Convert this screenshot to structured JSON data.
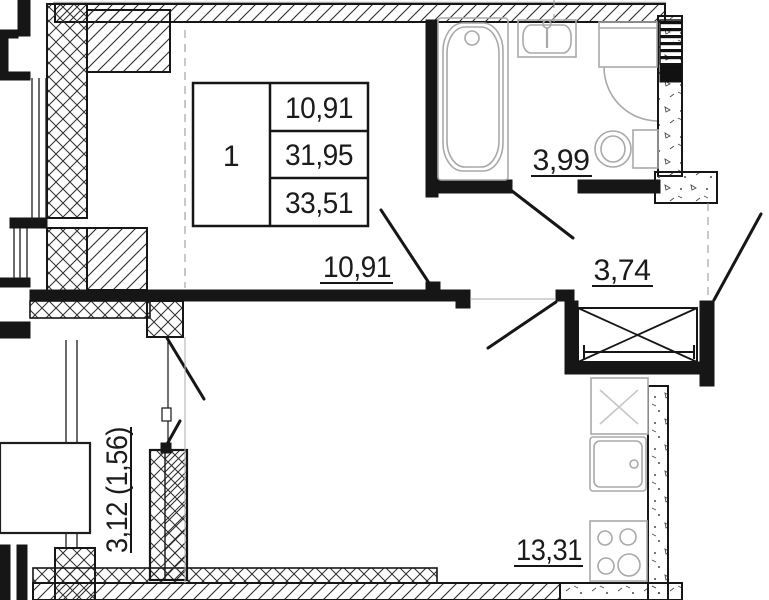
{
  "unit_table": {
    "number": "1",
    "rows": [
      "10,91",
      "31,95",
      "33,51"
    ]
  },
  "labels": {
    "bedroom": "10,91",
    "bathroom": "3,99",
    "hall": "3,74",
    "kitchen_living": "13,31",
    "balcony": "3,12 (1,56)"
  },
  "colors": {
    "wall": "#161616",
    "fixture": "#a9a9a9",
    "axis": "#9b9b9b"
  }
}
